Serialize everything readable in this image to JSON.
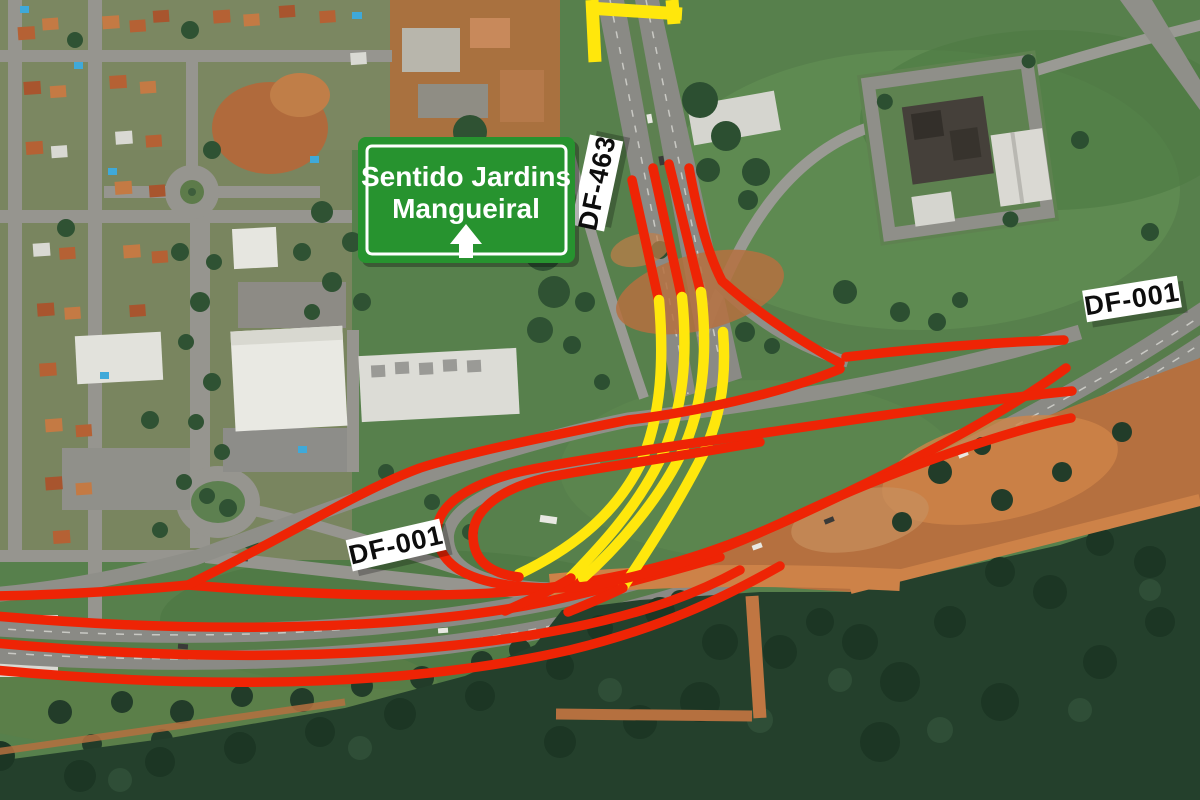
{
  "map": {
    "type_note": "aerial roadway detour scheme",
    "highways_shown": [
      "DF-463",
      "DF-001"
    ]
  },
  "road_labels": [
    {
      "id": "df463",
      "text": "DF-463"
    },
    {
      "id": "df001_right",
      "text": "DF-001"
    },
    {
      "id": "df001_center",
      "text": "DF-001"
    }
  ],
  "sign": {
    "line1": "Sentido Jardins",
    "line2": "Mangueiral",
    "arrow_icon": "up-arrow"
  },
  "colors": {
    "route_red": "#ee2405",
    "route_yellow": "#ffe70c",
    "sign_green": "#27932f",
    "sign_text": "#ffffff",
    "label_bg": "#ffffff",
    "label_text": "#0d0d0d"
  }
}
